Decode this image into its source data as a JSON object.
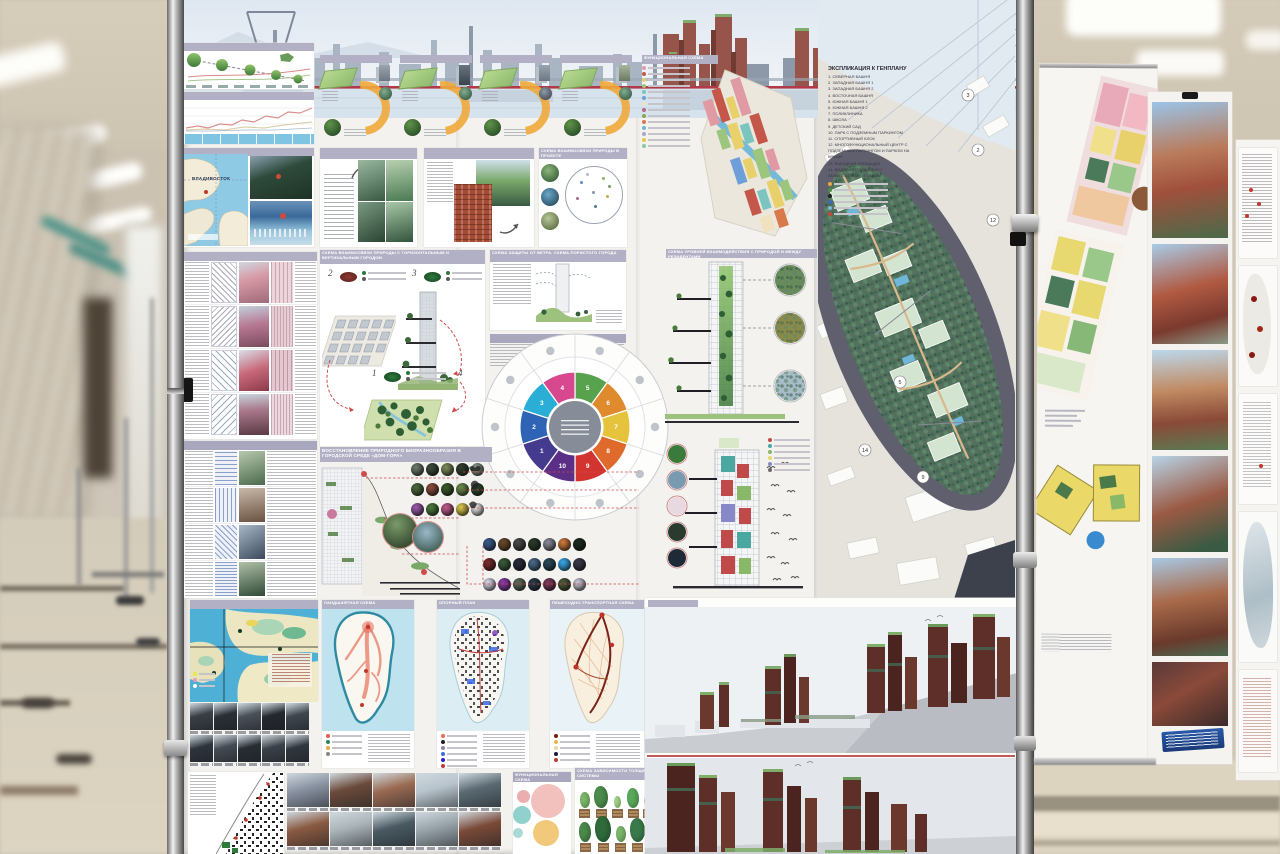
{
  "palette": {
    "header_bar": "#b2b0c5",
    "board_bg": "#f3f2ef",
    "hall_beige": "#cfc6b4",
    "floor_beige": "#d8d0bd",
    "water_blue": "#7fc4e0",
    "deep_water": "#4fb0d6",
    "red_waterline": "#b23a48",
    "brick_red": "#8a4a3a",
    "render_brick": "#5e2f28",
    "render_green": "#7fae6a",
    "road_dark": "#5f5f6e",
    "site_green": "#4e7d62",
    "roof_green": "#d3e4d0",
    "pool_blue": "#6fb7d9",
    "pink_tower": "#d79aa6",
    "orange_arrow": "#f0a93c"
  },
  "poster": {
    "labels": {
      "location": "ВЛАДИВОСТОК",
      "nature_city": "СХЕМА ВЗАИМОСВЯЗИ ПРИРОДЫ С ГОРИЗОНТАЛЬНЫМ И ВЕРТИКАЛЬНЫМ ГОРОДОМ",
      "wind": "СХЕМА ЗАЩИТЫ ОТ ВЕТРА. СХЕМА ПОРИСТОГО ГОРОДА",
      "nature_in_project": "СХЕМА ВЗАИМОСВЯЗИ ПРИРОДЫ В ПРОЕКТЕ",
      "biodiversity": "ВОССТАНОВЛЕНИЕ ПРИРОДНОГО БИОРАЗНООБРАЗИЯ В ГОРОДСКОЙ СРЕДЕ «ДОМ-ГОРА»",
      "interaction": "СХЕМА УРОВНЕЙ ВЗАИМОДЕЙСТВИЯ С ПРИРОДОЙ И МЕЖДУ РЕЗИДЕНТАМИ",
      "functional": "ФУНКЦИОНАЛЬНАЯ СХЕМА",
      "reference_plan": "ОПОРНЫЙ ПЛАН",
      "landscape": "ЛАНДШАФТНАЯ СХЕМА",
      "transport": "ПЕШЕХОДНО-ТРАНСПОРТНАЯ СХЕМА",
      "functional_bubbles": "ФУНКЦИОНАЛЬНАЯ СХЕМА",
      "roots": "СХЕМА ЗАВИСИМОСТИ ТОЛЩИНЫ ЗЕМЛИ ОТ КОРНЕВОЙ СИСТЕМЫ"
    },
    "steps": {
      "s1": "1",
      "s2": "2",
      "s3": "3",
      "s4": "4"
    },
    "wheel": {
      "center_color": "#868d99",
      "segments": [
        {
          "n": "5",
          "color": "#58a24e"
        },
        {
          "n": "6",
          "color": "#e08a2e"
        },
        {
          "n": "7",
          "color": "#e6c33c"
        },
        {
          "n": "8",
          "color": "#df6a2c"
        },
        {
          "n": "9",
          "color": "#d23430"
        },
        {
          "n": "10",
          "color": "#5b2f86"
        },
        {
          "n": "1",
          "color": "#443a8e"
        },
        {
          "n": "2",
          "color": "#2f63b5"
        },
        {
          "n": "3",
          "color": "#2aaed6"
        },
        {
          "n": "4",
          "color": "#d8488f"
        }
      ]
    },
    "genplan": {
      "title": "ЭКСПЛИКАЦИЯ К ГЕНПЛАНУ",
      "items": [
        "1. СЕВЕРНАЯ БАШНЯ",
        "2. ЗАПАДНАЯ БАШНЯ 1",
        "3. ЗАПАДНАЯ БАШНЯ 2",
        "4. ВОСТОЧНАЯ БАШНЯ",
        "5. ЮЖНАЯ БАШНЯ 1",
        "6. ЮЖНАЯ БАШНЯ 2",
        "7. ПОЛИКЛИНИКА",
        "8. ШКОЛА",
        "9. ДЕТСКИЙ САД",
        "10. ПАРК С ПОДЗЕМНЫМ ПАРКИНГОМ",
        "11. СПОРТИВНЫЙ БЛОК",
        "12. МНОГОФУНКЦИОНАЛЬНЫЙ ЦЕНТР С ПОДЗЕМНЫМ ПАРКИНГОМ И ПАРКОМ НА КРЫШЕ",
        "13. ВЪЕЗДНАЯ ПЛОЩАДКА",
        "14. ВИДОВАЯ ПЛОЩАДКА С АМФИТЕАТРАМИ И САДОМ"
      ],
      "plan_numbers": [
        "2",
        "3",
        "5",
        "9",
        "12",
        "14"
      ]
    },
    "legends": {
      "bathy": [
        "#e8e84a",
        "#e89ab8",
        "#ffffff"
      ],
      "landscape": [
        "#e85a4a",
        "#2a8a5a",
        "#e8a84a",
        "#888888"
      ],
      "reference": [
        "#e86a5a",
        "#222222",
        "#8a8aa8",
        "#3a6ae8",
        "#2222cc",
        "#c03a3a"
      ],
      "transport": [
        "#7a1a10",
        "#e8b84a",
        "#e8d8a8",
        "#1a1a3a",
        "#c03a30"
      ],
      "functional_axon": [
        "#e09aa4",
        "#c4574a",
        "#e8d06a",
        "#9cc67e",
        "#7cc4c0",
        "#6f9fd8",
        "#f0e2c0",
        "#b86a8a",
        "#8aa84a",
        "#d87a4a",
        "#6ab8d8",
        "#a8a8c8",
        "#e8c84a",
        "#88c8a8"
      ],
      "explication_marks": [
        "#e8a84a",
        "#4a8a4a",
        "#222222",
        "#3a6ab8",
        "#7ab8d8",
        "#c04a3a"
      ],
      "interaction": [
        "#c04a4a",
        "#4aa8a0",
        "#88b868",
        "#e8d870",
        "#8888c8",
        "#6a6a6a"
      ]
    },
    "species": {
      "g1": [
        [
          "#6b7a6a",
          "#3a4a3a",
          "#7a8a5a",
          "#2f3f2f",
          "#8a9a8a"
        ],
        [
          "#4a6a3a",
          "#8a4a3a",
          "#3a5a2a",
          "#6a8a4a",
          "#2a4a2a"
        ],
        [
          "#9a5aaa",
          "#4a7a3a",
          "#c05a8a",
          "#d8c84a",
          "#e8e8e8"
        ]
      ],
      "g2": [
        [
          "#3a5a8a",
          "#6a4a2a",
          "#4a4a4a",
          "#2a3a2a",
          "#8a8a9a",
          "#d07a3a",
          "#1a2a1a"
        ],
        [
          "#7a2a2a",
          "#3a5a3a",
          "#2a2a3a",
          "#4a6a8a",
          "#2a4a5a",
          "#38a8e8",
          "#3a3a4a"
        ],
        [
          "#d8d8e8",
          "#8a3aa8",
          "#5a6a5a",
          "#2a3a4a",
          "#7a3a5a",
          "#4a5a3a",
          "#c8c8d8"
        ]
      ]
    },
    "photos": {
      "industrial": [
        "#3a3f46",
        "#2a2f36",
        "#4a5058",
        "#23282e",
        "#3f464e",
        "#2e343c",
        "#454b52",
        "#282d34",
        "#3b4148",
        "#31373e"
      ],
      "site": [
        "#8a93a2",
        "#6a4a3a",
        "#9a6a52",
        "#b8c4cc",
        "#5a6a72",
        "#8a5a42",
        "#aab4b8",
        "#4a5a62",
        "#98a4aa",
        "#7a4a38"
      ]
    },
    "trees": {
      "row1": [
        [
          16,
          "#7ab86a"
        ],
        [
          22,
          "#4a8a4a"
        ],
        [
          12,
          "#a8d88a"
        ],
        [
          20,
          "#5aa85a"
        ],
        [
          14,
          "#88c878"
        ],
        [
          24,
          "#3a7a3a"
        ],
        [
          18,
          "#6ab85a"
        ],
        [
          21,
          "#4a9a5a"
        ]
      ],
      "row2": [
        [
          20,
          "#4a8a4a"
        ],
        [
          26,
          "#2f6a3a"
        ],
        [
          16,
          "#7ab86a"
        ],
        [
          24,
          "#3a7a4a"
        ],
        [
          18,
          "#5aa85a"
        ],
        [
          22,
          "#2a5a32"
        ]
      ]
    },
    "venn": {
      "colors": [
        "#f0b5b2",
        "#f0c063",
        "#7ec9c4",
        "#e8a0a0",
        "#9ad4ce"
      ]
    }
  }
}
